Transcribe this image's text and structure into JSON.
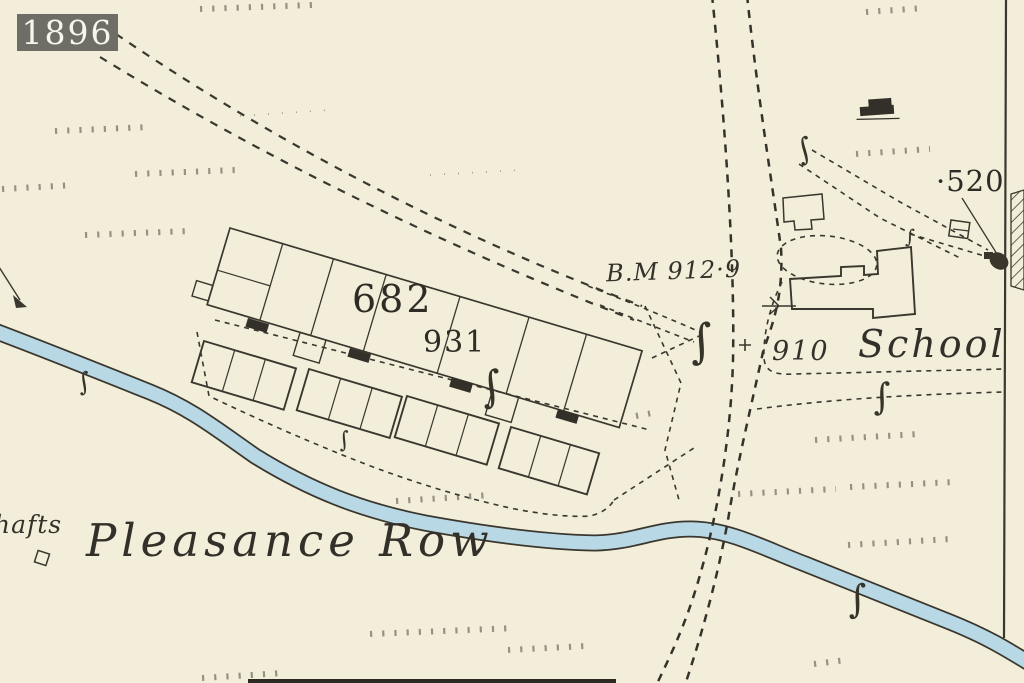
{
  "map": {
    "year_badge": "1896",
    "labels": {
      "parcel_682": "682",
      "parcel_931": "931",
      "benchmark": "B.M 912·9",
      "spot_910": "910",
      "school": "School",
      "spot_520": "·520",
      "pleasance_row": "Pleasance Row",
      "shafts_partial": "hafts"
    },
    "symbols": {
      "sluice_glyph": "∫",
      "plus_mark": "+"
    },
    "colors": {
      "paper": "#f3eeda",
      "ink": "#3a372e",
      "water_fill": "#b9d8e5",
      "water_edge": "#55524a",
      "badge_background": "#6e6e66",
      "badge_text": "#f8f6ec"
    }
  }
}
